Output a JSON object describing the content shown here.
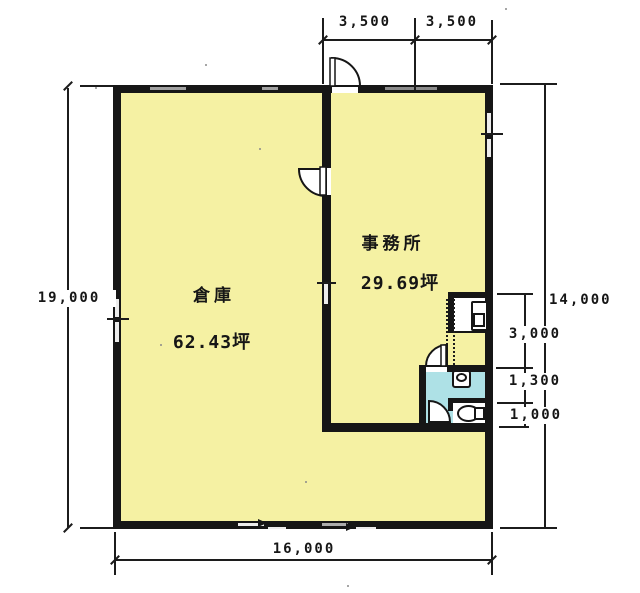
{
  "rooms": {
    "warehouse": {
      "name": "倉庫",
      "area": "62.43坪"
    },
    "office": {
      "name": "事務所",
      "area": "29.69坪"
    }
  },
  "dimensions": {
    "top_left": "3,500",
    "top_right": "3,500",
    "left": "19,000",
    "bottom": "16,000",
    "right_outer": "14,000",
    "right_inner": [
      "3,000",
      "1,300",
      "1,000"
    ]
  },
  "icons": {
    "doors": [
      "entry-door-arc-icon",
      "interior-door-arc-icon",
      "washroom-door-arc-icon",
      "toilet-door-arc-icon",
      "sliding-door-icon"
    ],
    "fixtures": [
      "urinal-icon",
      "basin-icon",
      "toilet-icon"
    ]
  },
  "colors": {
    "background": "#ffffff",
    "floor": "#f5f1a3",
    "wet_area": "#aee1e6",
    "wall": "#161616",
    "dimension": "#1c1c1c"
  }
}
